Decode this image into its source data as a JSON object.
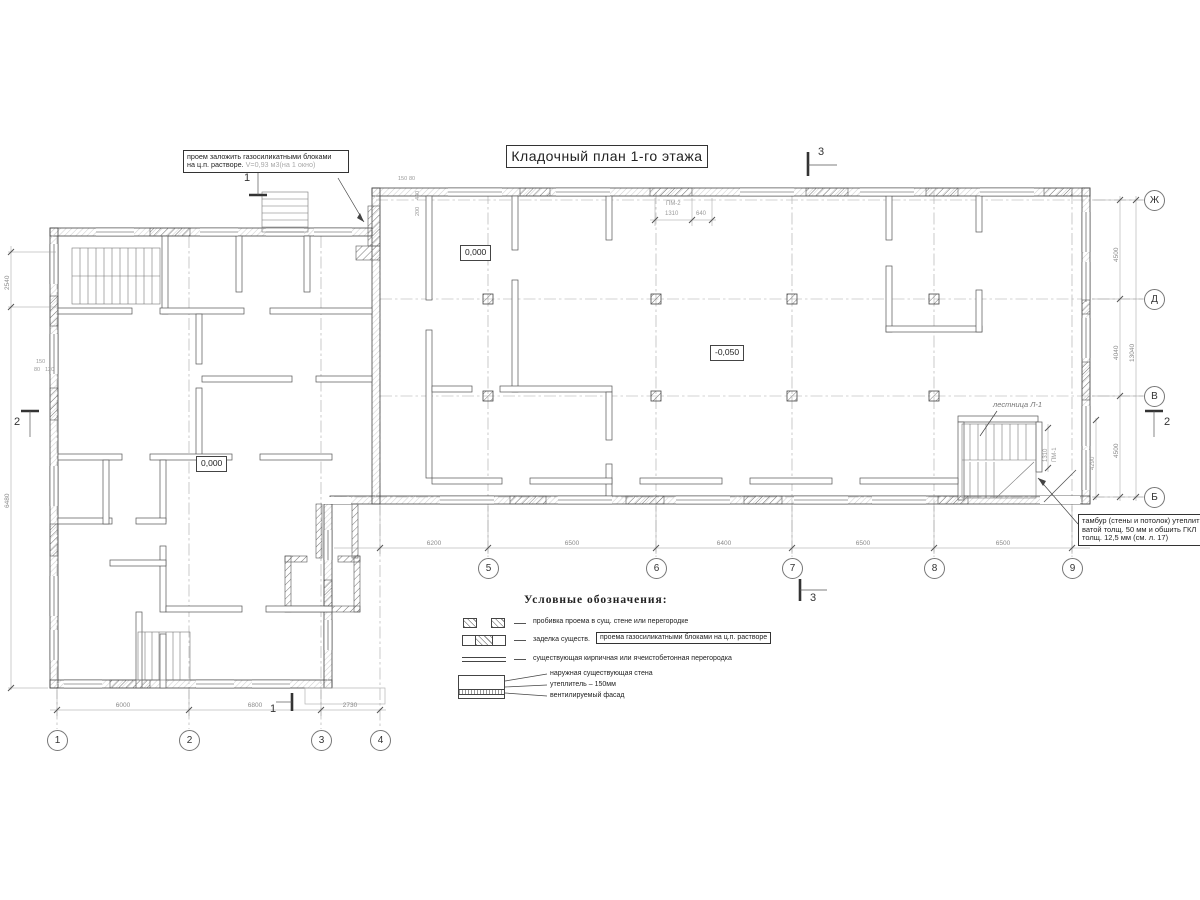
{
  "title": "Кладочный план 1-го этажа",
  "notes": {
    "opening": {
      "line1": "проем заложить газосиликатными блоками",
      "line2": "на ц.п. растворе.",
      "volume": "V=0,93 м3(на 1 окно)"
    },
    "tambour": {
      "line1": "тамбур (стены и потолок) утеплить",
      "line2": "ватой толщ. 50 мм и обшить ГКЛ",
      "line3": "толщ. 12,5 мм (см. л. 17)"
    },
    "stair": "лестница Л-1"
  },
  "elevations": {
    "right_wing": "0,000",
    "hall": "-0,050",
    "left_wing": "0,000"
  },
  "axes": {
    "numeric": [
      "1",
      "2",
      "3",
      "4",
      "5",
      "6",
      "7",
      "8",
      "9"
    ],
    "letter": [
      "Ж",
      "Д",
      "В",
      "Б"
    ]
  },
  "dims": {
    "bottom_left": [
      "6000",
      "6800",
      "2730"
    ],
    "bottom_right": [
      "6200",
      "6500",
      "6400",
      "6500",
      "6500"
    ],
    "right": [
      "4500",
      "4040",
      "4500"
    ],
    "right_total": "13040",
    "left": "2540",
    "left_total": "6480",
    "pm2": {
      "label": "ПМ-2",
      "a": "1310",
      "b": "640"
    },
    "pm1": {
      "label": "ПМ-1",
      "a": "1310"
    },
    "stair_width": "4290",
    "junction": [
      "150",
      "80",
      "440",
      "200"
    ],
    "left_wall": [
      "150",
      "80",
      "120"
    ]
  },
  "sections": {
    "s1": "1",
    "s2": "2",
    "s3": "3"
  },
  "legend": {
    "heading": "Условные обозначения:",
    "item1": "пробивка проема  в сущ. стене  или перегородке",
    "item2_prefix": "заделка существ.",
    "item2_boxed": "проема газосиликатными блоками на ц.п. растворе",
    "item3": "существующая кирпичная или ячеистобетонная перегородка",
    "item4_l1": "наружная существующая стена",
    "item4_l2": "утеплитель – 150мм",
    "item4_l3": "вентилируемый фасад"
  }
}
